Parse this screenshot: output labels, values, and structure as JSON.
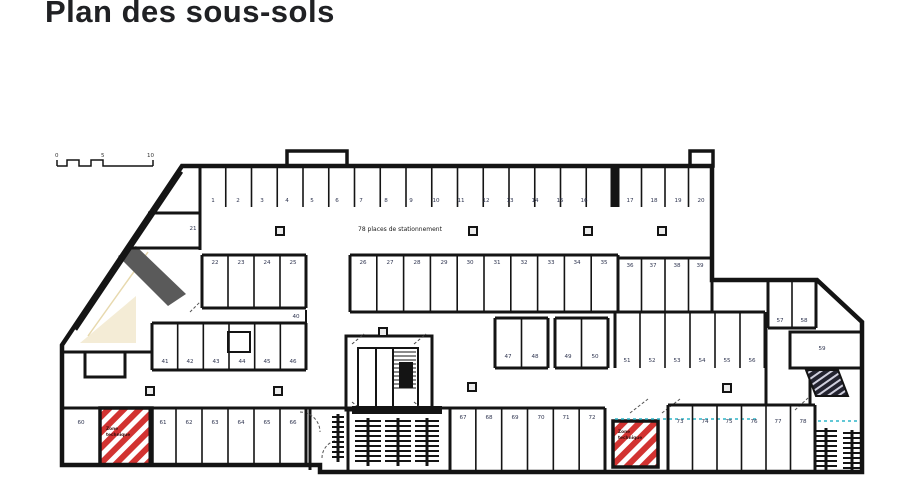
{
  "page": {
    "title": "Plan des sous-sols"
  },
  "scale_bar": {
    "labels": [
      "0",
      "5",
      "10"
    ]
  },
  "plan": {
    "capacity_note": "78 places de stationnement",
    "hatch_zones": [
      {
        "lines": [
          "Zone",
          "technique"
        ]
      },
      {
        "lines": [
          "Zone",
          "technique"
        ]
      }
    ],
    "ramp_label": "59",
    "stalls": [
      {
        "n": "1",
        "x": 213,
        "y": 202
      },
      {
        "n": "2",
        "x": 238,
        "y": 202
      },
      {
        "n": "3",
        "x": 262,
        "y": 202
      },
      {
        "n": "4",
        "x": 287,
        "y": 202
      },
      {
        "n": "5",
        "x": 312,
        "y": 202
      },
      {
        "n": "6",
        "x": 337,
        "y": 202
      },
      {
        "n": "7",
        "x": 361,
        "y": 202
      },
      {
        "n": "8",
        "x": 386,
        "y": 202
      },
      {
        "n": "9",
        "x": 411,
        "y": 202
      },
      {
        "n": "10",
        "x": 436,
        "y": 202
      },
      {
        "n": "11",
        "x": 461,
        "y": 202
      },
      {
        "n": "12",
        "x": 486,
        "y": 202
      },
      {
        "n": "13",
        "x": 510,
        "y": 202
      },
      {
        "n": "14",
        "x": 535,
        "y": 202
      },
      {
        "n": "15",
        "x": 560,
        "y": 202
      },
      {
        "n": "16",
        "x": 584,
        "y": 202
      },
      {
        "n": "17",
        "x": 630,
        "y": 202
      },
      {
        "n": "18",
        "x": 654,
        "y": 202
      },
      {
        "n": "19",
        "x": 678,
        "y": 202
      },
      {
        "n": "20",
        "x": 701,
        "y": 202
      },
      {
        "n": "21",
        "x": 193,
        "y": 230
      },
      {
        "n": "22",
        "x": 215,
        "y": 264
      },
      {
        "n": "23",
        "x": 241,
        "y": 264
      },
      {
        "n": "24",
        "x": 267,
        "y": 264
      },
      {
        "n": "25",
        "x": 293,
        "y": 264
      },
      {
        "n": "26",
        "x": 363,
        "y": 264
      },
      {
        "n": "27",
        "x": 390,
        "y": 264
      },
      {
        "n": "28",
        "x": 417,
        "y": 264
      },
      {
        "n": "29",
        "x": 444,
        "y": 264
      },
      {
        "n": "30",
        "x": 470,
        "y": 264
      },
      {
        "n": "31",
        "x": 497,
        "y": 264
      },
      {
        "n": "32",
        "x": 524,
        "y": 264
      },
      {
        "n": "33",
        "x": 551,
        "y": 264
      },
      {
        "n": "34",
        "x": 577,
        "y": 264
      },
      {
        "n": "35",
        "x": 604,
        "y": 264
      },
      {
        "n": "36",
        "x": 630,
        "y": 267
      },
      {
        "n": "37",
        "x": 653,
        "y": 267
      },
      {
        "n": "38",
        "x": 677,
        "y": 267
      },
      {
        "n": "39",
        "x": 700,
        "y": 267
      },
      {
        "n": "40",
        "x": 296,
        "y": 318
      },
      {
        "n": "41",
        "x": 165,
        "y": 363
      },
      {
        "n": "42",
        "x": 190,
        "y": 363
      },
      {
        "n": "43",
        "x": 216,
        "y": 363
      },
      {
        "n": "44",
        "x": 242,
        "y": 363
      },
      {
        "n": "45",
        "x": 267,
        "y": 363
      },
      {
        "n": "46",
        "x": 293,
        "y": 363
      },
      {
        "n": "47",
        "x": 508,
        "y": 358
      },
      {
        "n": "48",
        "x": 535,
        "y": 358
      },
      {
        "n": "49",
        "x": 568,
        "y": 358
      },
      {
        "n": "50",
        "x": 595,
        "y": 358
      },
      {
        "n": "51",
        "x": 627,
        "y": 362
      },
      {
        "n": "52",
        "x": 652,
        "y": 362
      },
      {
        "n": "53",
        "x": 677,
        "y": 362
      },
      {
        "n": "54",
        "x": 702,
        "y": 362
      },
      {
        "n": "55",
        "x": 727,
        "y": 362
      },
      {
        "n": "56",
        "x": 752,
        "y": 362
      },
      {
        "n": "57",
        "x": 780,
        "y": 322
      },
      {
        "n": "58",
        "x": 804,
        "y": 322
      },
      {
        "n": "59",
        "x": 822,
        "y": 350
      },
      {
        "n": "60",
        "x": 81,
        "y": 424
      },
      {
        "n": "61",
        "x": 163,
        "y": 424
      },
      {
        "n": "62",
        "x": 189,
        "y": 424
      },
      {
        "n": "63",
        "x": 215,
        "y": 424
      },
      {
        "n": "64",
        "x": 241,
        "y": 424
      },
      {
        "n": "65",
        "x": 267,
        "y": 424
      },
      {
        "n": "66",
        "x": 293,
        "y": 424
      },
      {
        "n": "67",
        "x": 463,
        "y": 419
      },
      {
        "n": "68",
        "x": 489,
        "y": 419
      },
      {
        "n": "69",
        "x": 515,
        "y": 419
      },
      {
        "n": "70",
        "x": 541,
        "y": 419
      },
      {
        "n": "71",
        "x": 566,
        "y": 419
      },
      {
        "n": "72",
        "x": 592,
        "y": 419
      },
      {
        "n": "73",
        "x": 680,
        "y": 423
      },
      {
        "n": "74",
        "x": 705,
        "y": 423
      },
      {
        "n": "75",
        "x": 729,
        "y": 423
      },
      {
        "n": "76",
        "x": 754,
        "y": 423
      },
      {
        "n": "77",
        "x": 778,
        "y": 423
      },
      {
        "n": "78",
        "x": 803,
        "y": 423
      }
    ]
  },
  "colors": {
    "wall": "#141414",
    "hatch_red": "#d23331",
    "ramp_gray": "#5a5a5a",
    "beige": "#f4ecd6",
    "cyan": "#2fb6c9",
    "label": "#2f3550"
  }
}
